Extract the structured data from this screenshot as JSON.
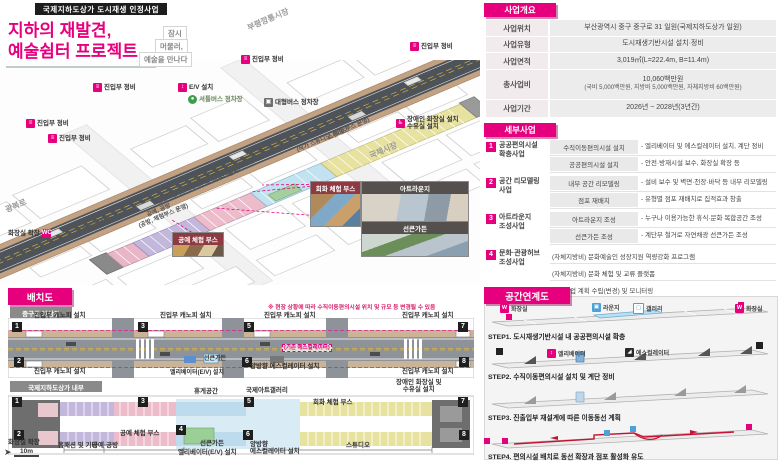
{
  "header": {
    "program_badge": "국제지하도상가 도시재생 인정사업",
    "title_line1": "지하의 재발견,",
    "title_line2": "예술쉼터 프로젝트",
    "bubble": [
      "잠시",
      "머물러,",
      "예술을 만나다"
    ]
  },
  "map": {
    "streets": {
      "bupyeong": "부평깡통시장",
      "gukje": "국제시장",
      "gwangbok": "광복로"
    },
    "labels": {
      "entrance": "진입부 정비",
      "elevator": "E/V 설치",
      "shuttle": "셔틀버스 정차장",
      "bus": "대형버스 정차장",
      "accessible_line1": "장애인 화장실 설치",
      "accessible_line2": "수유실 설치",
      "toilet_expand": "화장실 확장",
      "studio": "스튜디오",
      "studio_sub": "(작가 스튜디오, 체험 부스 운영)",
      "artlounge": "아트라운지",
      "sunken": "선큰가든 (휴게공간, 갤러리, 아트샵)",
      "craft": "공예, 공방",
      "craft_sub": "(공방, 체험부스 운영)",
      "homefashion": "홈패션, 기타"
    },
    "callouts": {
      "paint": "회화 체험 부스",
      "artlounge": "아트라운지",
      "sunken": "선큰가든",
      "craft": "공예 체험 부스"
    }
  },
  "overview": {
    "title": "사업개요",
    "rows": [
      {
        "label": "사업위치",
        "value": "부산광역시 중구 중구로 31 일원(국제지하도상가 일원)"
      },
      {
        "label": "사업유형",
        "value": "도시재생기반시설 설치·정비"
      },
      {
        "label": "사업면적",
        "value": "3,019㎡(L=222.4m, B=11.4m)"
      },
      {
        "label": "총사업비",
        "value": "10,060백만원",
        "note": "(국비 5,000백만원, 지방비 5,000백만원, 자체지방비 60백만원)"
      },
      {
        "label": "사업기간",
        "value": "2026년 ~ 2028년(3년간)"
      }
    ]
  },
  "detail": {
    "title": "세부사업",
    "groups": [
      {
        "num": "1",
        "name1": "공공편의시설",
        "name2": "확충사업",
        "items": [
          {
            "mid": "수직이동편의시설 설치",
            "desc": "- 엘리베이터 및 에스컬레이터 설치, 계단 정비"
          },
          {
            "mid": "공공편의시설 설치",
            "desc": "- 안전·방재시설 보수, 화장실 확장 등"
          }
        ]
      },
      {
        "num": "2",
        "name1": "공간 리모델링",
        "name2": "사업",
        "items": [
          {
            "mid": "내부 공간 리모델링",
            "desc": "- 설비 보수 및 벽면·천장·바닥 등 내부 리모델링"
          },
          {
            "mid": "점포 재배치",
            "desc": "- 유형별 점포 재배치로 집적효과 창출"
          }
        ]
      },
      {
        "num": "3",
        "name1": "아트라운지",
        "name2": "조성사업",
        "items": [
          {
            "mid": "아트라운지 조성",
            "desc": "- 누구나 이용가능한 휴식·문화 복합공간 조성"
          },
          {
            "mid": "선큰가든 조성",
            "desc": "- 계단부 철거로 자연채광 선큰가든 조성"
          }
        ]
      },
      {
        "num": "4",
        "name1": "문화·관광허브",
        "name2": "조성사업",
        "lines": [
          "(자체지방비) 문화예술인 성장지원 역량강화 프로그램",
          "(자체지방비) 문화 체험 및 교류 플랫폼",
          "인정사업 계획 수립(변경) 및 모니터링"
        ]
      }
    ]
  },
  "layout": {
    "title": "배치도",
    "note": "※ 현장 상황에 따라 수직이동편의시설 위치 및 규모 등 변경될 수 있음",
    "markers": [
      "1",
      "2",
      "3",
      "4",
      "5",
      "6",
      "7",
      "8"
    ],
    "surface": {
      "subtitle": "중구로 지상부",
      "canopy": "진입부 캐노피 설치",
      "escalator": "양방향 에스컬레이터 설치",
      "existing": "(기존 에스컬레이터)",
      "sunken": "선큰가든",
      "elevator": "엘리베이터(E/V) 설치"
    },
    "interior": {
      "subtitle": "국제지하도상가 내부",
      "toilet": "화장실 확장",
      "scale": "10m",
      "homefashion": "홈패션 및 기타",
      "craft": "공예·공방",
      "craft_booth": "공예 체험 부스",
      "sunken": "선큰가든",
      "elevator": "엘리베이터(E/V) 설치",
      "rest": "휴게공간",
      "gallery": "국제아트갤러리",
      "paint_booth": "회화 체험 부스",
      "studio": "스튜디오",
      "escalator_line1": "양방향",
      "escalator_line2": "에스컬레이터 설치",
      "accessible_line1": "장애인 화장실 및",
      "accessible_line2": "수유실 설치"
    }
  },
  "steps": {
    "title": "공간연계도",
    "rows": [
      {
        "caption": "STEP1. 도시재생기반시설 내 공공편의시설 확충",
        "l1": "화장실",
        "l2": "라운지",
        "l3": "갤러리",
        "l4": "화장실"
      },
      {
        "caption": "STEP2. 수직이동편의시설 설치 및 계단 정비",
        "l1": "엘리베이터",
        "l2": "에스컬레이터"
      },
      {
        "caption": "STEP3. 진출입부 재설계에 따른 이동동선 계획"
      },
      {
        "caption": "STEP4. 편의시설 배치로 동선 확장과 점포 활성화 유도"
      }
    ]
  }
}
